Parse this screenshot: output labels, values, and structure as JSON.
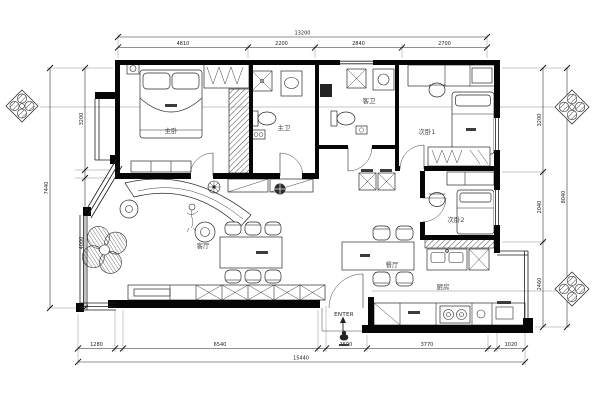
{
  "plan": {
    "type": "apartment-floor-plan",
    "rooms": {
      "master_bedroom": "主卧",
      "master_bath": "主卫",
      "guest_bath": "客卫",
      "bedroom_1": "次卧1",
      "bedroom_2": "次卧2",
      "living_room": "客厅",
      "dining_room": "餐厅",
      "kitchen": "厨房",
      "entry": "ENTER"
    },
    "dimensions": {
      "top": {
        "total": "13200",
        "segments": [
          "4810",
          "2200",
          "2840",
          "2700"
        ]
      },
      "bottom": {
        "total": "15440",
        "segments": [
          "1280",
          "6540",
          "1500",
          "3770",
          "1020"
        ]
      },
      "left": {
        "total": "7440",
        "segments": [
          "3200",
          "4000"
        ]
      },
      "right": {
        "total": "8040",
        "segments": [
          "3200",
          "2040",
          "2460"
        ]
      }
    },
    "colors": {
      "paper": "#ffffff",
      "wall_ink": "#060606",
      "furniture_ink": "#2a2a2a",
      "label_ink": "#4a4a4a",
      "dimension_ink": "#222222"
    }
  }
}
